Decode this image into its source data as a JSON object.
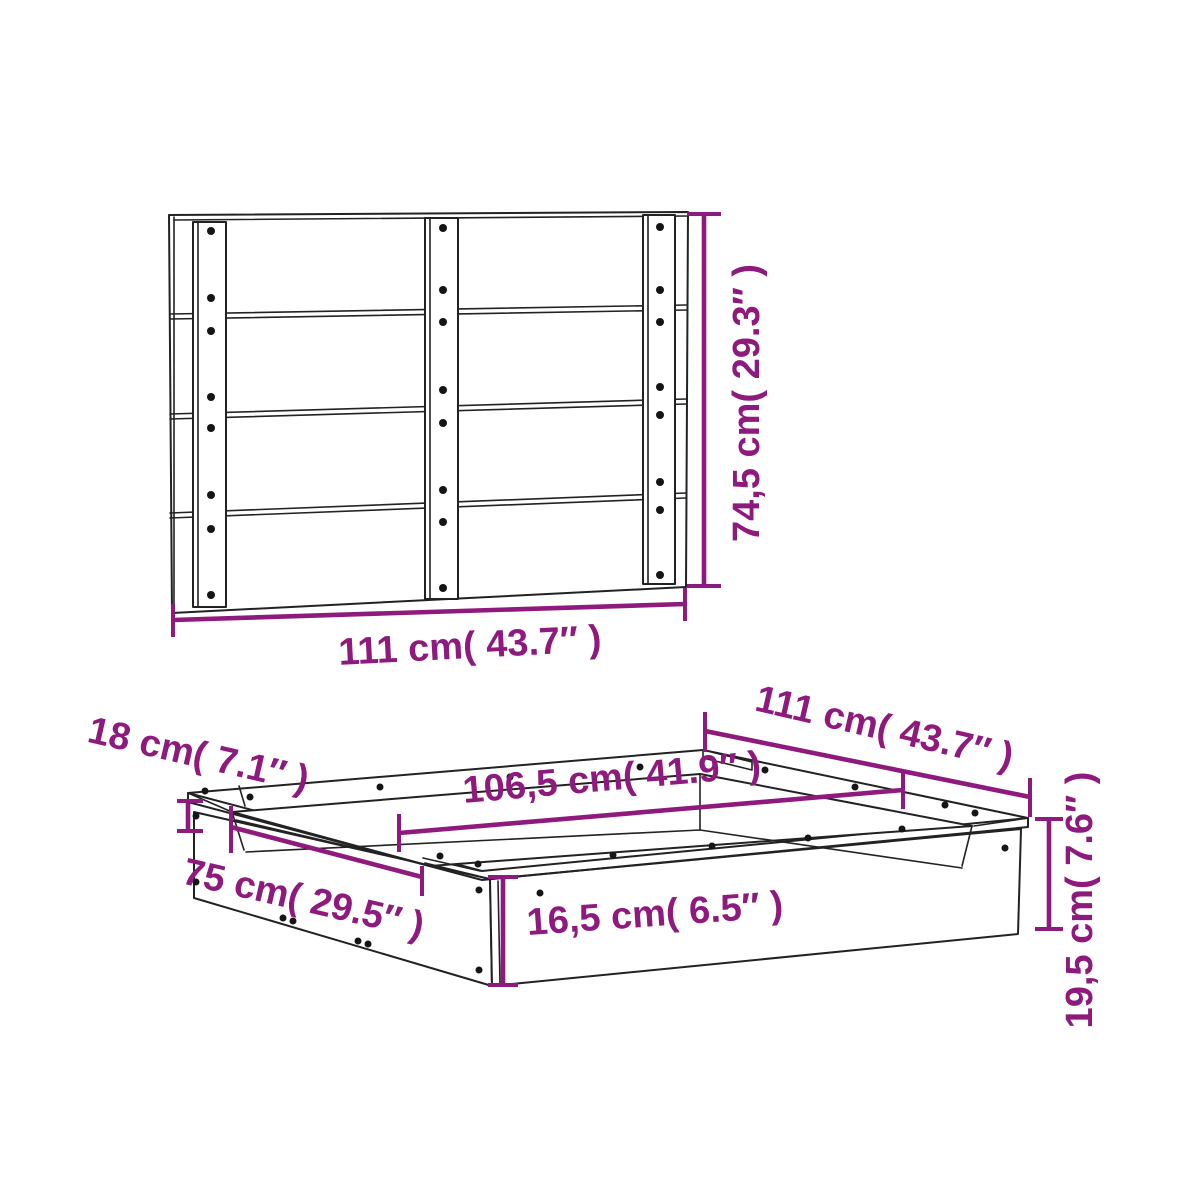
{
  "figure": {
    "type": "product-dimension-diagram",
    "product": "sandbox with back panel"
  },
  "colors": {
    "dimension": "#8e1a7e",
    "outline": "#222222",
    "background": "#ffffff"
  },
  "panel_view": {
    "name": "back panel front view",
    "width_label": "111 cm( 43.7″ )",
    "height_label": "74,5 cm( 29.3″ )"
  },
  "sandbox_view": {
    "name": "sandbox perspective view",
    "seat_width_label": "18 cm( 7.1″ )",
    "outer_length_label": "111 cm( 43.7″ )",
    "inner_length_label": "106,5 cm( 41.9″ )",
    "inner_width_label": "75 cm( 29.5″ )",
    "wall_height_label": "16,5 cm( 6.5″ )",
    "total_height_label": "19,5 cm( 7.6″ )"
  }
}
